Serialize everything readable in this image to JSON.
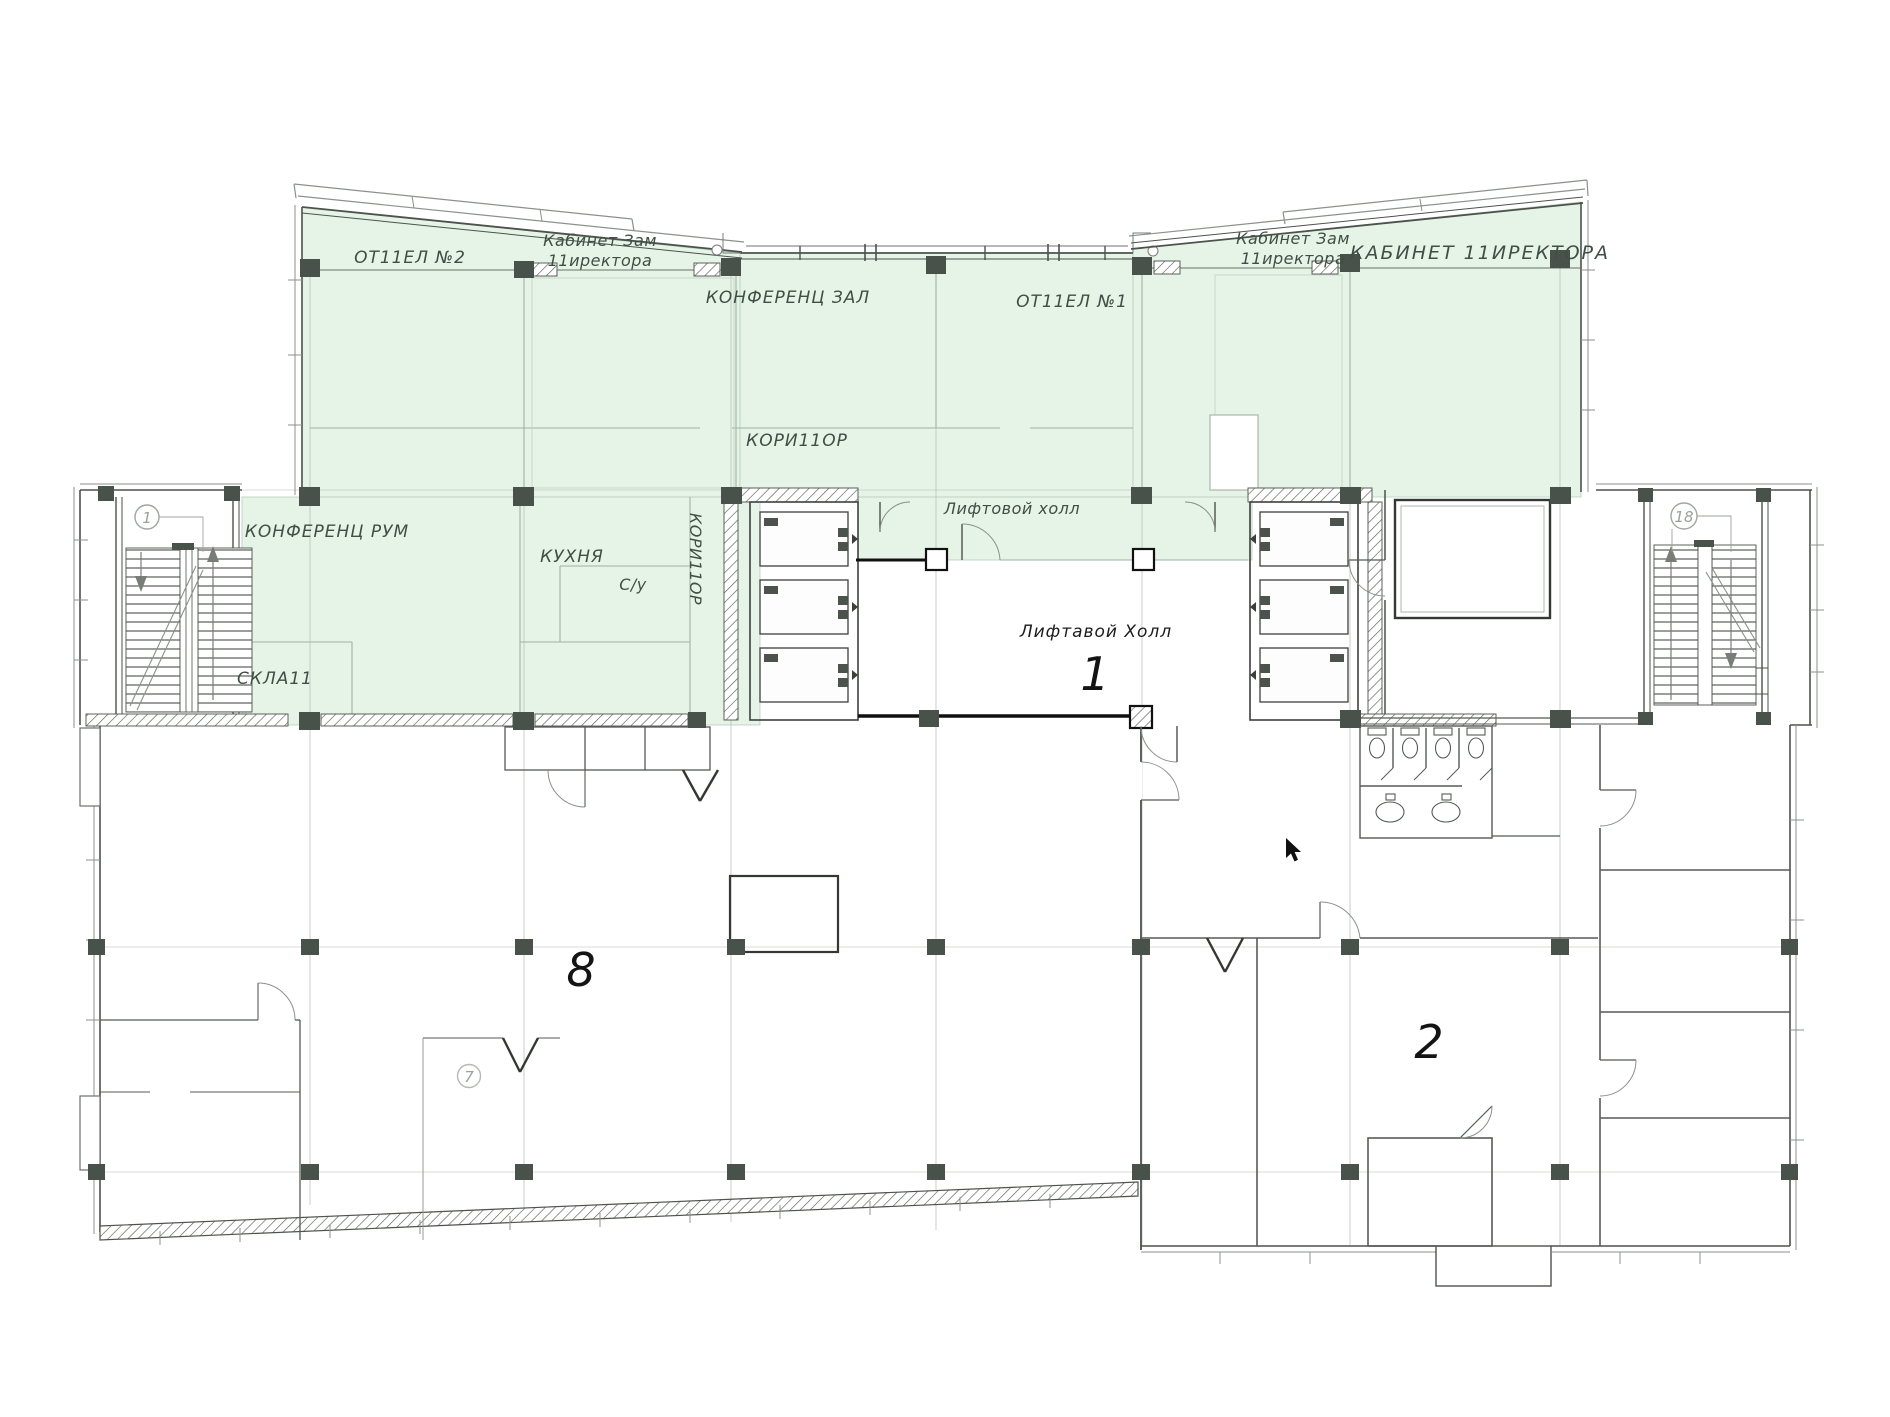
{
  "document": {
    "type": "architectural-floor-plan"
  },
  "colors": {
    "highlight_fill": "#e6f3e7",
    "highlight_line": "#b7cfbb",
    "wall_dark": "#4c524c",
    "wall_mid": "#6b716b",
    "wall_light": "#9aa69c",
    "grid_line": "#b4bab4",
    "column_fill": "#49524a",
    "black": "#111111",
    "label_green": "#3f4f45",
    "label_dark": "#1c1c1c",
    "bubble": "#a0a6a0"
  },
  "labels": {
    "otdel_2": "ОТ11ЕЛ №2",
    "kab_zam_left_line1": "Кабинет Зам",
    "kab_zam_left_line2": "11иректора",
    "konferenc_zal": "КОНФЕРЕНЦ ЗАЛ",
    "otdel_1": "ОТ11ЕЛ №1",
    "kab_zam_right_line1": "Кабинет Зам",
    "kab_zam_right_line2": "11иректора",
    "kabinet_direktora": "КАБИНЕТ 11ИРЕКТОРА",
    "koridor_top": "КОРИ11ОР",
    "lift_hall_green": "Лифтовой холл",
    "konferenc_rum": "КОНФЕРЕНЦ РУМ",
    "kuhnya": "КУХНЯ",
    "su": "С/у",
    "koridor_vertical": "КОРИ11ОР",
    "sklad": "СКЛА11",
    "lift_hall_main": "Лифтавой Холл"
  },
  "zone_numbers": {
    "lift_hall": "1",
    "open_area": "8",
    "zone_right": "2"
  },
  "grid_bubbles": {
    "axis_left": "1",
    "axis_right": "18",
    "axis_mid": "7"
  }
}
